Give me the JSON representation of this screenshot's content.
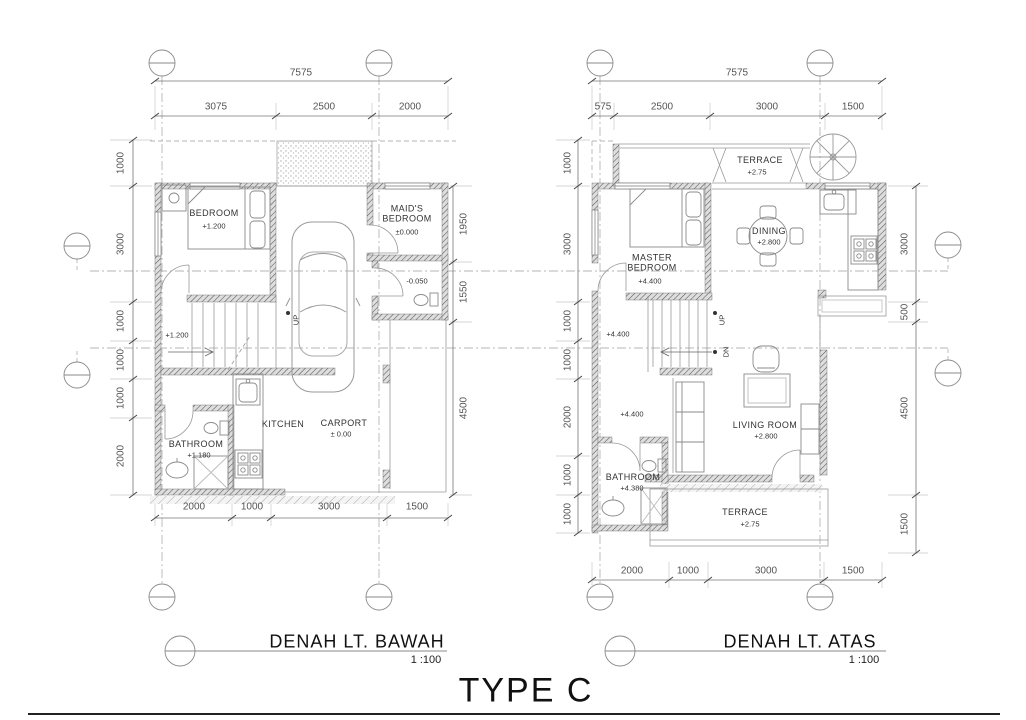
{
  "drawing": {
    "type_label": "TYPE C",
    "titles": {
      "lower": {
        "name": "DENAH LT. BAWAH",
        "scale": "1 :100"
      },
      "upper": {
        "name": "DENAH LT. ATAS",
        "scale": "1 :100"
      }
    }
  },
  "lower_plan": {
    "dims": {
      "overall": "7575",
      "top": [
        "3075",
        "2500",
        "2000"
      ],
      "bottom": [
        "2000",
        "1000",
        "3000",
        "1500"
      ],
      "left": [
        "1000",
        "3000",
        "1000",
        "1000",
        "1000",
        "2000"
      ],
      "right": [
        "1950",
        "1550",
        "4500"
      ]
    },
    "rooms": {
      "bedroom": {
        "name": "BEDROOM",
        "level": "+1.200"
      },
      "maids_bedroom": {
        "name": "MAID'S BEDROOM",
        "level": "±0.000"
      },
      "bathroom": {
        "name": "BATHROOM",
        "level": "+1.180"
      },
      "kitchen": {
        "name": "KITCHEN"
      },
      "carport": {
        "name": "CARPORT",
        "level": "± 0.00"
      }
    },
    "labels": {
      "stair_level": "+1.200",
      "maid_toilet_level": "-0.050",
      "up": "UP"
    }
  },
  "upper_plan": {
    "dims": {
      "overall": "7575",
      "top": [
        "575",
        "2500",
        "3000",
        "1500"
      ],
      "bottom": [
        "2000",
        "1000",
        "3000",
        "1500"
      ],
      "left": [
        "1000",
        "3000",
        "1000",
        "1000",
        "2000",
        "1000",
        "1000"
      ],
      "right": [
        "3000",
        "500",
        "4500",
        "1500"
      ]
    },
    "rooms": {
      "terrace_top": {
        "name": "TERRACE",
        "level": "+2.75"
      },
      "master_bedroom": {
        "name": "MASTER BEDROOM",
        "level": "+4.400"
      },
      "dining": {
        "name": "DINING",
        "level": "+2.800"
      },
      "living_room": {
        "name": "LIVING ROOM",
        "level": "+2.800"
      },
      "bathroom": {
        "name": "BATHROOM",
        "level": "+4.380"
      },
      "terrace_bottom": {
        "name": "TERRACE",
        "level": "+2.75"
      }
    },
    "labels": {
      "hall_level_upper": "+4.400",
      "hall_level_lower": "+4.400",
      "up": "UP",
      "dn": "DN"
    }
  }
}
